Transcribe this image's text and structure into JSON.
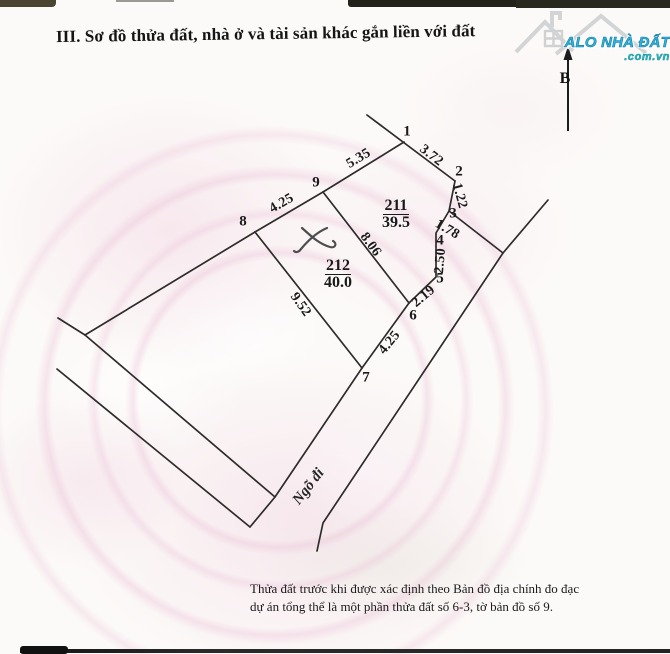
{
  "title": "III. Sơ đồ thửa đất, nhà ở và tài sản khác gắn liền với đất",
  "logo": {
    "name": "ALO NHÀ ĐẤT",
    "domain": ".com.vn",
    "icon": "house-icon",
    "name_color": "#2cb6dc",
    "domain_color": "#2fc0c8"
  },
  "compass": {
    "label": "B"
  },
  "road": {
    "label": "Ngõ đi",
    "x": 309,
    "y": 487,
    "rot": -52
  },
  "parcels": [
    {
      "number": "211",
      "area": "39.5",
      "x": 396,
      "y": 199
    },
    {
      "number": "212",
      "area": "40.0",
      "x": 338,
      "y": 259
    }
  ],
  "vertices": [
    {
      "n": "1",
      "x": 407,
      "y": 132
    },
    {
      "n": "2",
      "x": 459,
      "y": 172
    },
    {
      "n": "3",
      "x": 453,
      "y": 214
    },
    {
      "n": "4",
      "x": 440,
      "y": 241
    },
    {
      "n": "5",
      "x": 440,
      "y": 279
    },
    {
      "n": "6",
      "x": 413,
      "y": 316
    },
    {
      "n": "7",
      "x": 366,
      "y": 378
    },
    {
      "n": "8",
      "x": 243,
      "y": 222
    },
    {
      "n": "9",
      "x": 316,
      "y": 183
    }
  ],
  "measurements": [
    {
      "value": "5.35",
      "x": 359,
      "y": 159,
      "rot": -31
    },
    {
      "value": "3.72",
      "x": 431,
      "y": 156,
      "rot": 38
    },
    {
      "value": "1.22",
      "x": 459,
      "y": 196,
      "rot": 75
    },
    {
      "value": "1.78",
      "x": 447,
      "y": 230,
      "rot": 30
    },
    {
      "value": "2.50",
      "x": 441,
      "y": 261,
      "rot": -85
    },
    {
      "value": "2.19",
      "x": 424,
      "y": 297,
      "rot": -40
    },
    {
      "value": "4.25",
      "x": 282,
      "y": 204,
      "rot": -30
    },
    {
      "value": "4.25",
      "x": 390,
      "y": 343,
      "rot": -51
    },
    {
      "value": "8.06",
      "x": 370,
      "y": 245,
      "rot": 54
    },
    {
      "value": "9.52",
      "x": 300,
      "y": 305,
      "rot": 55
    }
  ],
  "footer": {
    "line1": "Thửa đất trước khi được xác định theo Bản đồ địa chính đo đạc",
    "line2": "dự án tổng thể là một phần thửa đất số 6-3, tờ bản đồ số 9."
  },
  "geometry": {
    "boundary_lines": [
      [
        [
          367,
          115
        ],
        [
          455,
          181
        ]
      ],
      [
        [
          323,
          192
        ],
        [
          404,
          142
        ]
      ],
      [
        [
          455,
          181
        ],
        [
          449,
          211
        ],
        [
          436,
          233
        ],
        [
          436,
          277
        ],
        [
          409,
          303
        ]
      ],
      [
        [
          409,
          303
        ],
        [
          362,
          368
        ]
      ],
      [
        [
          255,
          232
        ],
        [
          323,
          192
        ]
      ],
      [
        [
          323,
          192
        ],
        [
          409,
          303
        ]
      ],
      [
        [
          255,
          232
        ],
        [
          362,
          368
        ]
      ],
      [
        [
          255,
          232
        ],
        [
          85,
          335
        ],
        [
          58,
          318
        ]
      ],
      [
        [
          85,
          335
        ],
        [
          275,
          497
        ]
      ],
      [
        [
          362,
          368
        ],
        [
          275,
          497
        ],
        [
          250,
          527
        ]
      ],
      [
        [
          57,
          369
        ],
        [
          250,
          527
        ]
      ],
      [
        [
          449,
          211
        ],
        [
          503,
          253
        ]
      ],
      [
        [
          548,
          200
        ],
        [
          503,
          253
        ],
        [
          323,
          523
        ],
        [
          317,
          551
        ]
      ]
    ]
  }
}
